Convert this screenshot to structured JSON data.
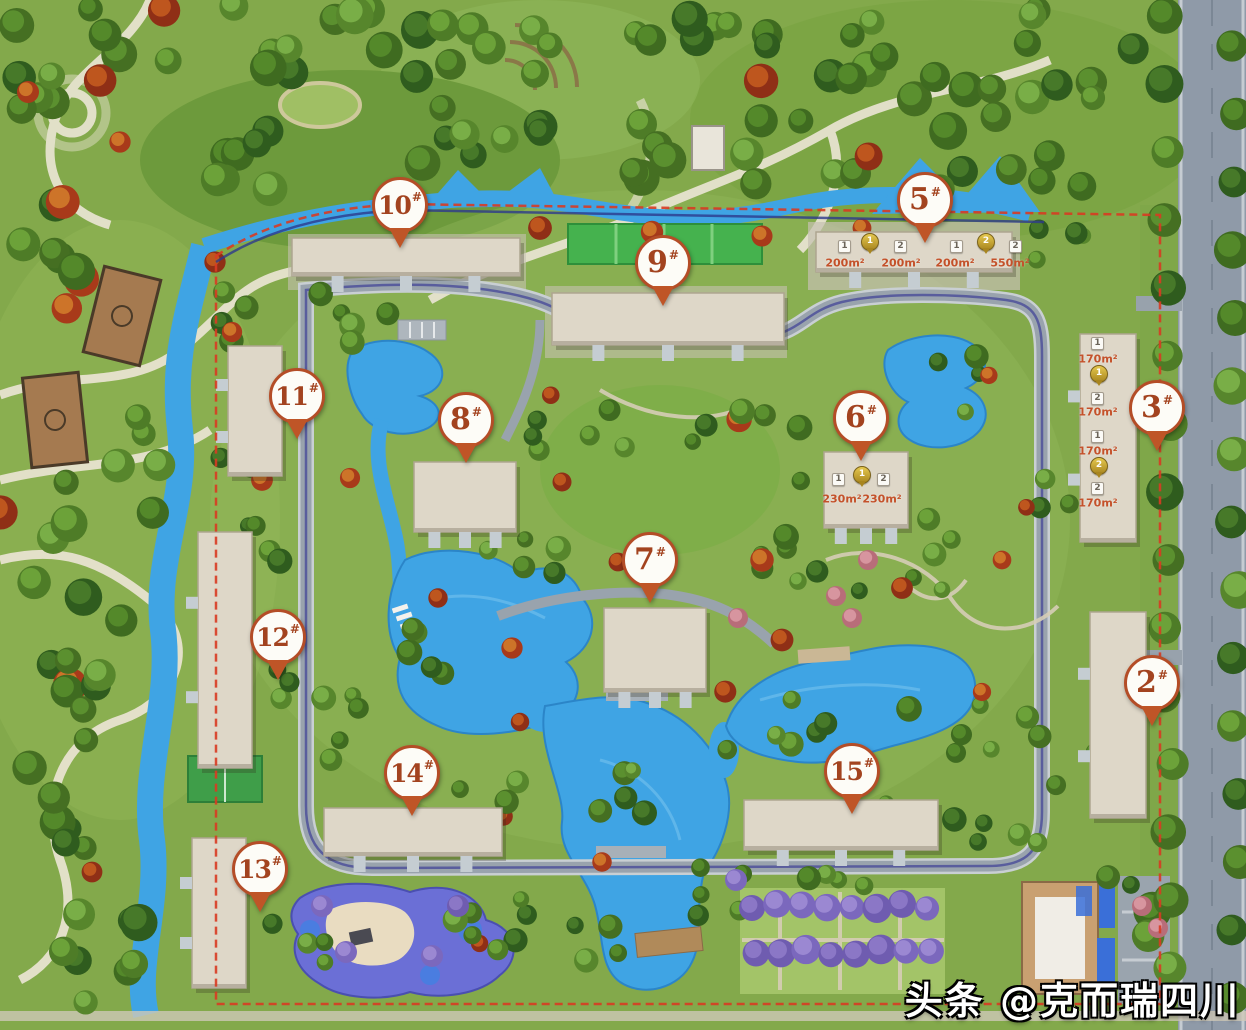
{
  "markers": [
    {
      "label": "10",
      "sup": "#",
      "x": 400,
      "y": 205
    },
    {
      "label": "5",
      "sup": "#",
      "x": 925,
      "y": 200
    },
    {
      "label": "9",
      "sup": "#",
      "x": 663,
      "y": 263
    },
    {
      "label": "11",
      "sup": "#",
      "x": 297,
      "y": 396
    },
    {
      "label": "8",
      "sup": "#",
      "x": 466,
      "y": 420
    },
    {
      "label": "6",
      "sup": "#",
      "x": 861,
      "y": 418
    },
    {
      "label": "3",
      "sup": "#",
      "x": 1157,
      "y": 408
    },
    {
      "label": "7",
      "sup": "#",
      "x": 650,
      "y": 560
    },
    {
      "label": "12",
      "sup": "#",
      "x": 278,
      "y": 637
    },
    {
      "label": "2",
      "sup": "#",
      "x": 1152,
      "y": 683
    },
    {
      "label": "14",
      "sup": "#",
      "x": 412,
      "y": 773
    },
    {
      "label": "15",
      "sup": "#",
      "x": 852,
      "y": 771
    },
    {
      "label": "13",
      "sup": "#",
      "x": 260,
      "y": 869
    }
  ],
  "floorplan_labels": [
    {
      "building": "5",
      "items": [
        {
          "t": "badge",
          "v": "1",
          "x": 845,
          "y": 247
        },
        {
          "t": "pin",
          "v": "1",
          "x": 869,
          "y": 243
        },
        {
          "t": "badge",
          "v": "2",
          "x": 901,
          "y": 247
        },
        {
          "t": "badge",
          "v": "1",
          "x": 957,
          "y": 247
        },
        {
          "t": "pin",
          "v": "2",
          "x": 985,
          "y": 243
        },
        {
          "t": "badge",
          "v": "2",
          "x": 1016,
          "y": 247
        },
        {
          "t": "area",
          "v": "200m²",
          "x": 845,
          "y": 263
        },
        {
          "t": "area",
          "v": "200m²",
          "x": 901,
          "y": 263
        },
        {
          "t": "area",
          "v": "200m²",
          "x": 955,
          "y": 263
        },
        {
          "t": "area",
          "v": "550m²",
          "x": 1010,
          "y": 263
        }
      ]
    },
    {
      "building": "6",
      "items": [
        {
          "t": "badge",
          "v": "1",
          "x": 839,
          "y": 480
        },
        {
          "t": "pin",
          "v": "1",
          "x": 861,
          "y": 476
        },
        {
          "t": "badge",
          "v": "2",
          "x": 884,
          "y": 480
        },
        {
          "t": "area",
          "v": "230m²",
          "x": 842,
          "y": 499
        },
        {
          "t": "area",
          "v": "230m²",
          "x": 882,
          "y": 499
        }
      ]
    },
    {
      "building": "3",
      "items": [
        {
          "t": "badge",
          "v": "1",
          "x": 1098,
          "y": 344
        },
        {
          "t": "area",
          "v": "170m²",
          "x": 1098,
          "y": 359
        },
        {
          "t": "pin",
          "v": "1",
          "x": 1098,
          "y": 375
        },
        {
          "t": "badge",
          "v": "2",
          "x": 1098,
          "y": 399
        },
        {
          "t": "area",
          "v": "170m²",
          "x": 1098,
          "y": 412
        },
        {
          "t": "badge",
          "v": "1",
          "x": 1098,
          "y": 437
        },
        {
          "t": "area",
          "v": "170m²",
          "x": 1098,
          "y": 451
        },
        {
          "t": "pin",
          "v": "2",
          "x": 1098,
          "y": 467
        },
        {
          "t": "badge",
          "v": "2",
          "x": 1098,
          "y": 489
        },
        {
          "t": "area",
          "v": "170m²",
          "x": 1098,
          "y": 503
        }
      ]
    }
  ],
  "watermark": {
    "text": "头条 @克而瑞四川"
  },
  "colors": {
    "marker_ring": "#b44d27",
    "marker_text": "#a3431f",
    "area_text": "#c4512a",
    "boundary_red": "#d83b22",
    "track_navy": "#2d3a8c",
    "water": "#3fa4e4",
    "gold_pin": "#c9a22c"
  }
}
